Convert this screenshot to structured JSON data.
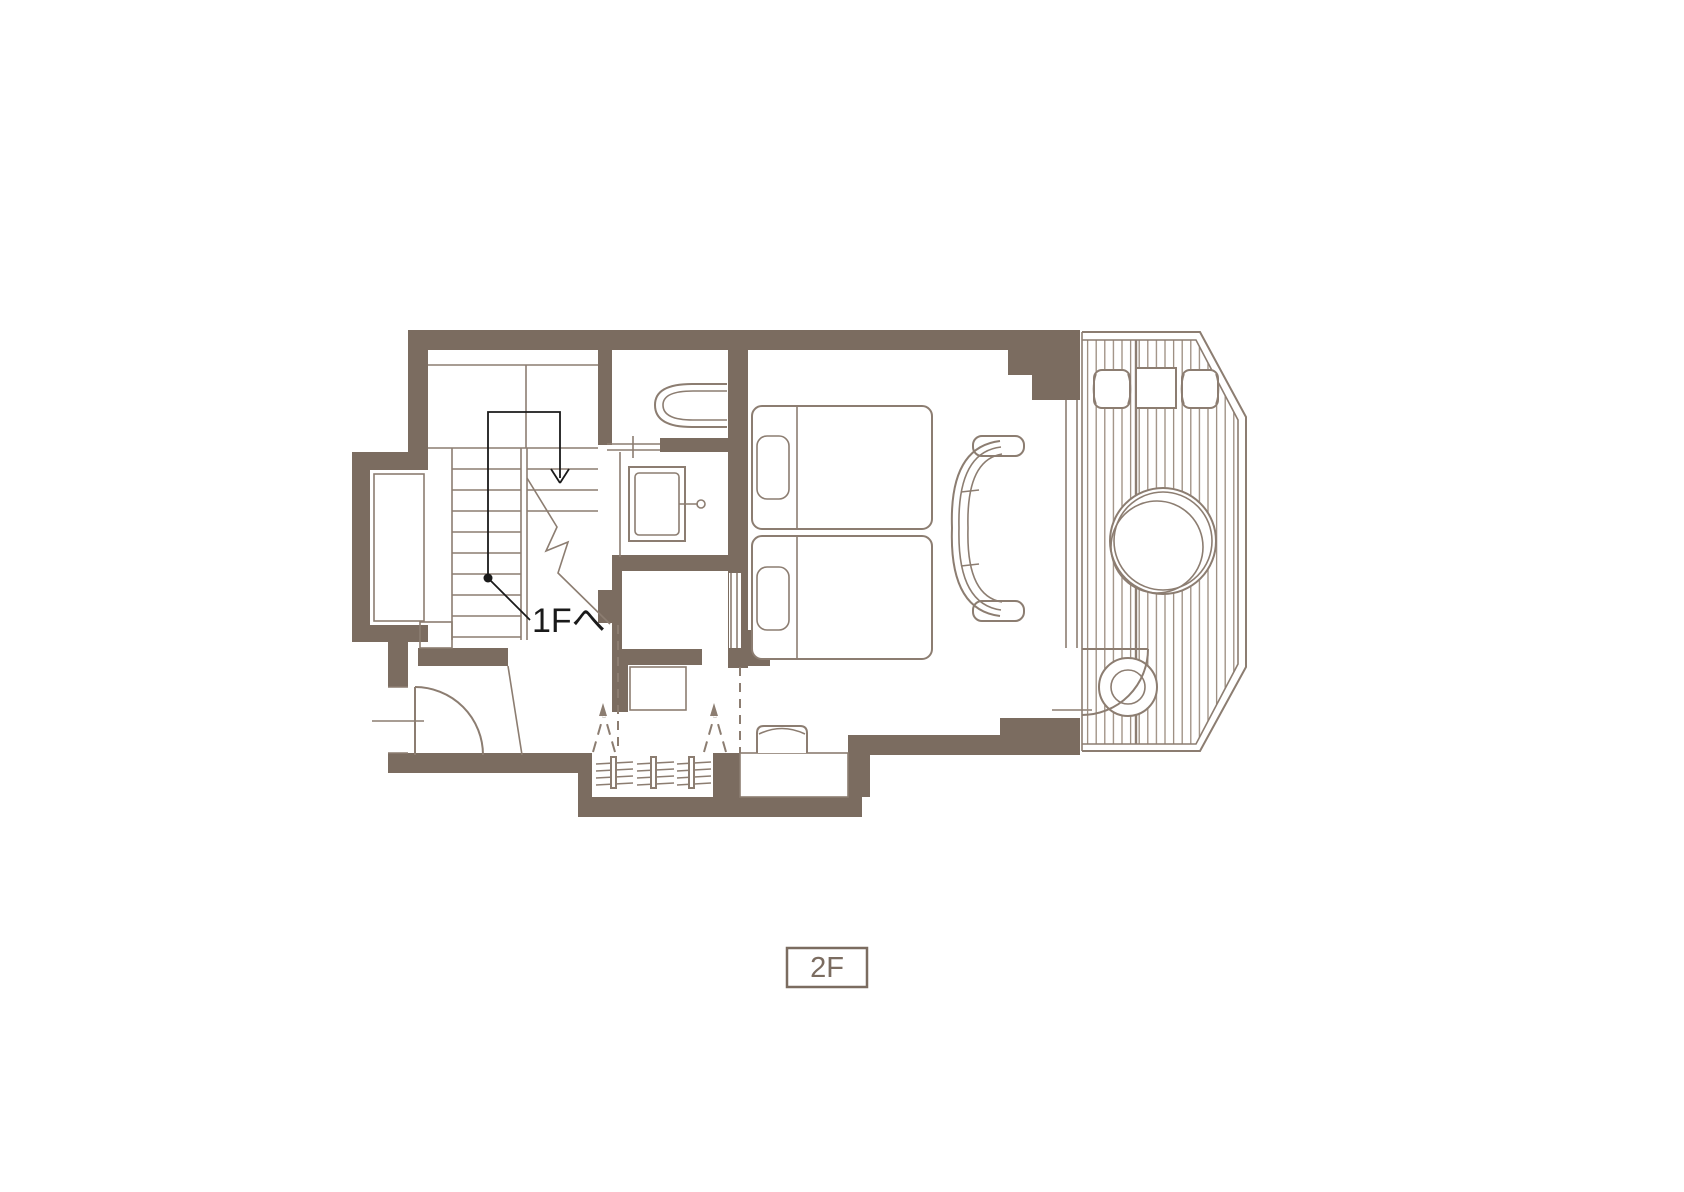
{
  "annotations": {
    "stair_destination_label": "1Fへ",
    "floor_badge": "2F"
  },
  "colors": {
    "wall": "#7b6c60",
    "line": "#8c7d71",
    "slat": "#9c8d80",
    "annotation": "#1a1a1a",
    "bg": "#ffffff"
  }
}
